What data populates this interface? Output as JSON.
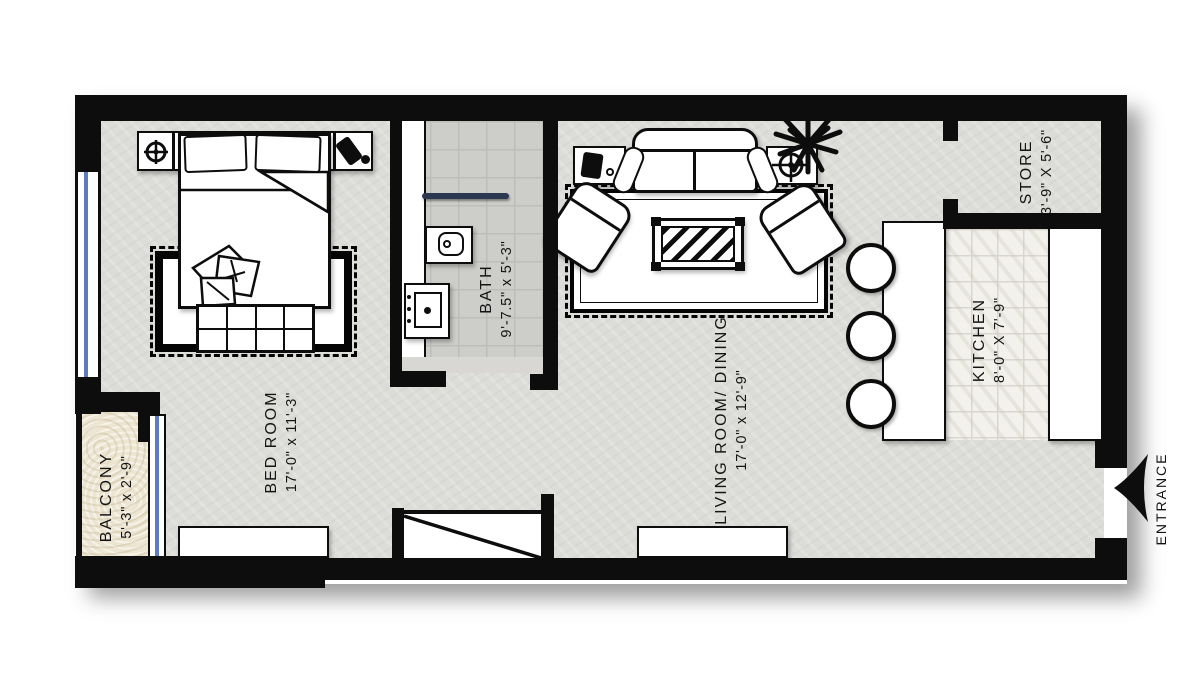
{
  "rooms": {
    "bedroom": {
      "name": "BED ROOM",
      "dims": "17'-0\" x 11'-3\""
    },
    "bath": {
      "name": "BATH",
      "dims": "9'-7.5\" x 5'-3\""
    },
    "living": {
      "name": "LIVING ROOM/ DINING",
      "dims": "17'-0\" x 12'-9\""
    },
    "kitchen": {
      "name": "KITCHEN",
      "dims": "8'-0\" X 7'-9\""
    },
    "store": {
      "name": "STORE",
      "dims": "3'-9\" X 5'-6\""
    },
    "balcony": {
      "name": "BALCONY",
      "dims": "5'-3\" x 2'-9\""
    }
  },
  "entrance": {
    "label": "ENTRANCE",
    "arrow_direction": "left"
  },
  "icons": {
    "entrance_arrow": "swept arrowhead pointing left",
    "plant": "black starburst foliage",
    "alarm_clock": "circle with crosshair on left nightstand",
    "phone": "tilted handset block on right nightstand",
    "table_lamp": "black block on left side table",
    "target_plate": "circle with long crosshair on right side table"
  },
  "colors": {
    "wall": "#0d0d0d",
    "floor": "#dcddd9",
    "bath_tile": "#cdcdca",
    "kitchen_tile": "#f2f1ec",
    "balcony_floor": "#ece5d2",
    "window_glass": "#5f7cc0",
    "towel_bar": "#2c3850",
    "shadow": "rgba(0,0,0,0.38)"
  }
}
